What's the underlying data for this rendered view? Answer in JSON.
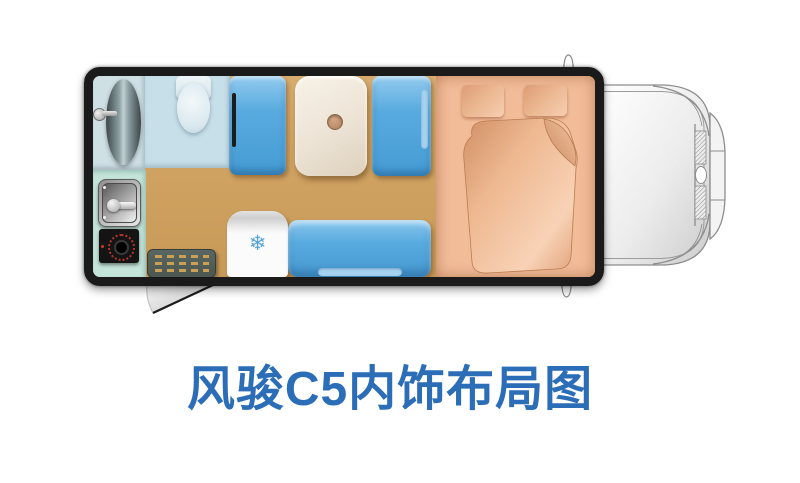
{
  "title": {
    "text": "风骏C5内饰布局图"
  },
  "diagram": {
    "type": "rv-floorplan-top-view",
    "fridge": {
      "snowflake_icon": "❄"
    },
    "colors": {
      "title_blue": "#2c6db7",
      "trailer_border": "#1a1a1a",
      "floor_tan": "#d2a565",
      "seat_blue": "#58abdf",
      "seat_blue_light": "#a5d2ee",
      "bed_salmon": "#f2bc99",
      "pillow_dark": "#dd9c76",
      "pillow_light": "#f7ceb2",
      "table_cream": "#ece3d5",
      "bathroom_blue": "#c7dfe9",
      "shower_gray_blue": "#cfe0e5",
      "kitchen_mint": "#c4e4da",
      "mat_gray": "#4d5751",
      "mat_dash": "#c9a055",
      "fridge_white": "#fbfbfb",
      "snowflake_blue": "#54a3da",
      "burner_red": "#b5352b",
      "cab_line_gray": "#8d8d8d"
    }
  }
}
